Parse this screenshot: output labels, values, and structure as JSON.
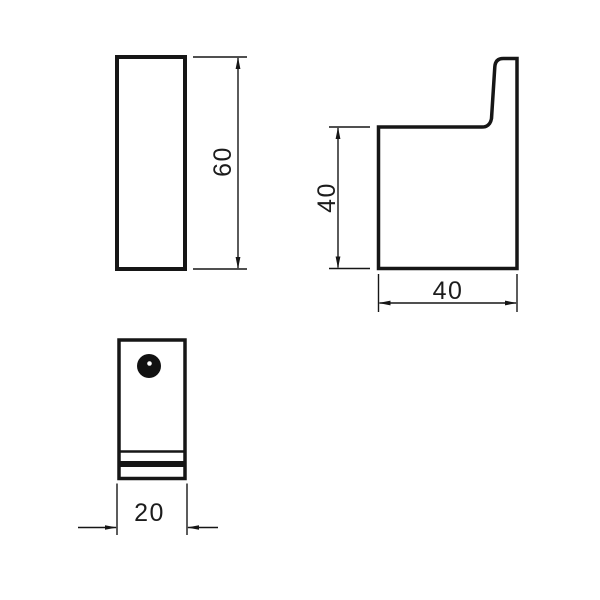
{
  "colors": {
    "line": "#161616",
    "background": "#ffffff"
  },
  "views": {
    "front": {
      "height_dim": "60"
    },
    "side": {
      "height_dim": "40",
      "depth_dim": "40"
    },
    "bottom": {
      "width_dim": "20"
    }
  },
  "chart_data": {
    "type": "table",
    "title": "Orthographic technical drawing of wall hook bracket",
    "dimensions": [
      {
        "view": "front",
        "measure": "height",
        "value": 60
      },
      {
        "view": "side",
        "measure": "height",
        "value": 40
      },
      {
        "view": "side",
        "measure": "depth",
        "value": 40
      },
      {
        "view": "bottom",
        "measure": "width",
        "value": 20
      }
    ]
  }
}
